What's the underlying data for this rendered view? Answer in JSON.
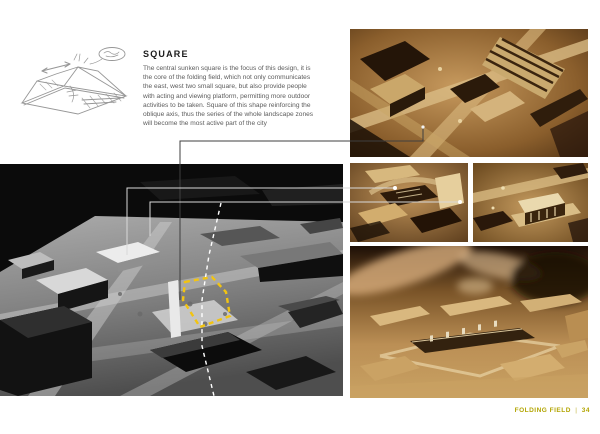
{
  "document": {
    "article": {
      "title": "SQUARE",
      "body": "The central sunken square is the focus of this design, it is the core of the folding field, which not only communicates the east, west two small square, but also provide people with acting and viewing platform, permitting more outdoor activities to be taken. Square of this shape reinforcing the oblique axis, thus the series of the whole landscape zones will become the most active part of the city"
    },
    "footer": {
      "label": "FOLDING FIELD",
      "separator": "|",
      "page_number": "34"
    },
    "colors": {
      "footer_text": "#b3a503",
      "highlight_dashed_outline": "#f2c411",
      "axis_dashed_line": "#ffffff",
      "leader_line_light": "#d9d9d9",
      "leader_line_dark": "#3f3f3f",
      "sepia_photo_base": "#c49a5e",
      "monochrome_photo_base": "#0b0b0b"
    },
    "figures": [
      {
        "id": "concept-sketch",
        "kind": "pencil-sketch"
      },
      {
        "id": "site-model-photo",
        "kind": "monochrome-model-photo"
      },
      {
        "id": "model-aerial-photo",
        "kind": "sepia-model-photo"
      },
      {
        "id": "model-detail-photo-1",
        "kind": "sepia-model-photo"
      },
      {
        "id": "model-detail-photo-2",
        "kind": "sepia-model-photo"
      },
      {
        "id": "model-making-photo",
        "kind": "sepia-model-photo"
      }
    ]
  }
}
